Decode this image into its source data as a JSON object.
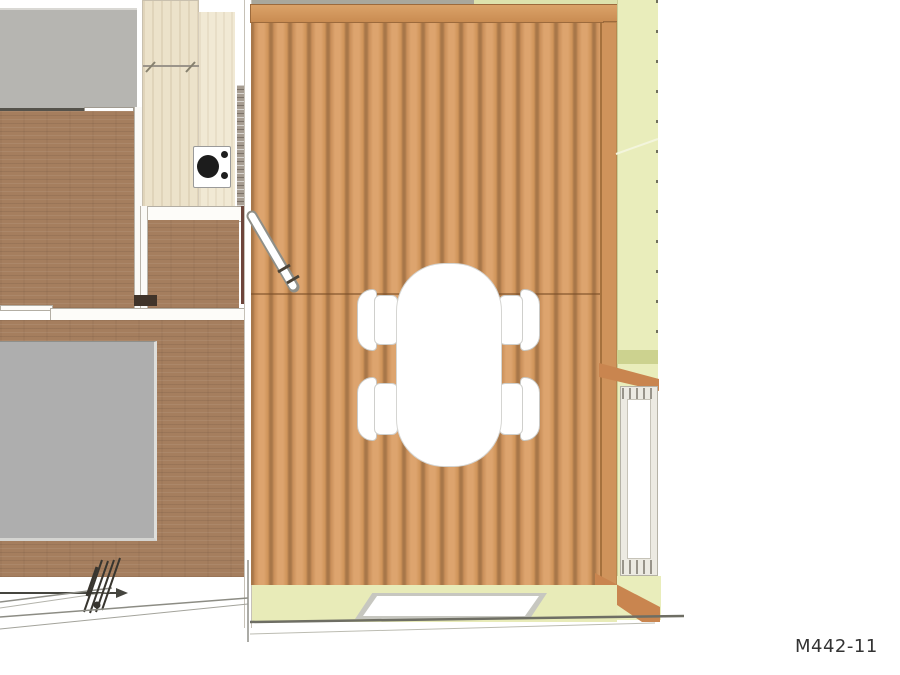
{
  "drawing": {
    "number_label": "M442-11"
  },
  "colors": {
    "background": "#ffffff",
    "deck_plank": "#d9a069",
    "deck_plank_gap": "#a87749",
    "deck_edge_beam": "#cf935b",
    "wood_beam": "#c9854f",
    "interior_floor_brown": "#a57e5e",
    "kitchen_counter_wood": "#ece2ca",
    "side_wall_green": "#e9edbb",
    "porch_floor_green": "#e8ebb8",
    "bed_mat_gray": "#aeaeae",
    "upper_surface_gray": "#b6b5b1",
    "dark_red_wall": "#6e453b",
    "white_wall": "#fdfcf9",
    "stove_burner_black": "#1c1c1c",
    "annotation_line_dark": "#45453f",
    "label_text": "#333333"
  },
  "objects": {
    "dining_table_chair_count": 4,
    "stove_large_burners": 1,
    "stove_small_burners": 2,
    "skylight_panels": 1,
    "side_windows": 1
  }
}
